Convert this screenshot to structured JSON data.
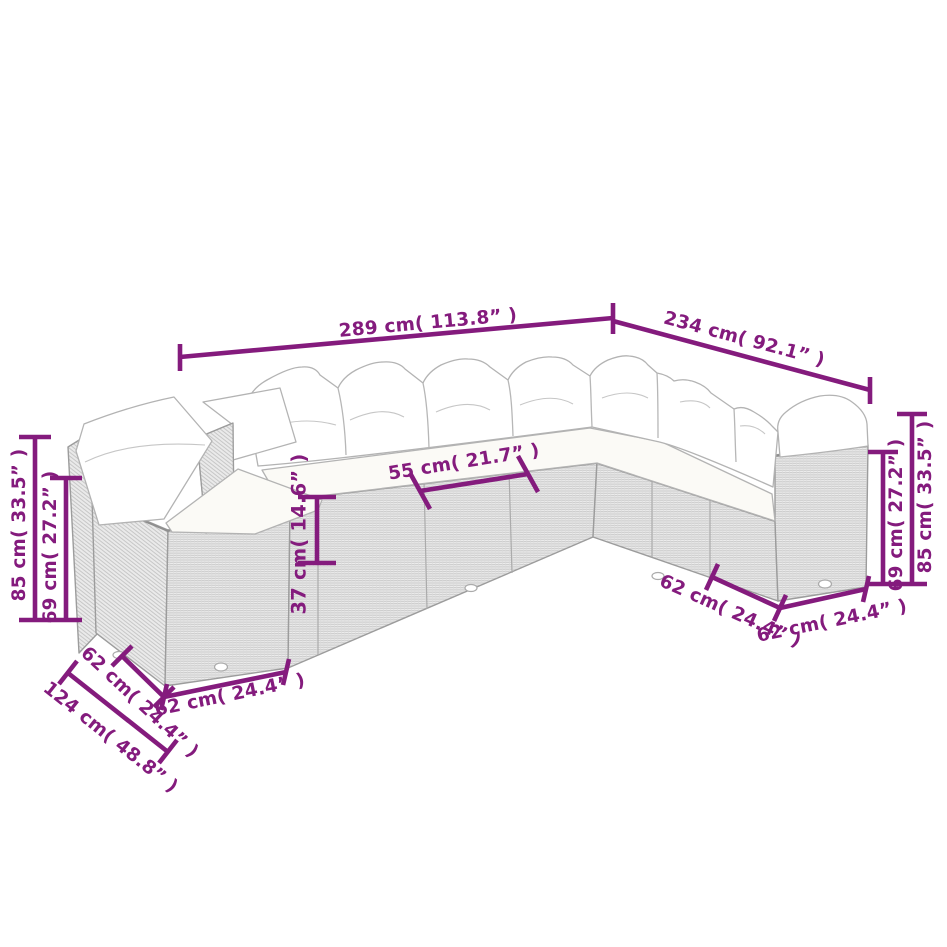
{
  "diagram": {
    "background_color": "#ffffff",
    "dimension_color": "#841b7d",
    "sofa_outline_color": "#9c9c9c",
    "cushion_color": "#ffffff",
    "wicker_color": "#ececec",
    "labels": {
      "top_width": "289 cm( 113.8” )",
      "right_width": "234 cm( 92.1” )",
      "back_height_left": "85 cm( 33.5” )",
      "arm_height_left": "69 cm( 27.2” )",
      "seat_width": "55 cm( 21.7” )",
      "seat_height": "37 cm( 14.6” )",
      "arm_height_right": "69 cm( 27.2” )",
      "back_height_right": "85 cm( 33.5” )",
      "seat_depth_front_right": "62 cm( 24.4” )",
      "arm_width_right": "62 cm( 24.4” )",
      "seat_depth_left": "62 cm( 24.4” )",
      "left_wing_depth": "124 cm( 48.8” )",
      "seat_width_left_front": "62 cm( 24.4” )"
    }
  }
}
